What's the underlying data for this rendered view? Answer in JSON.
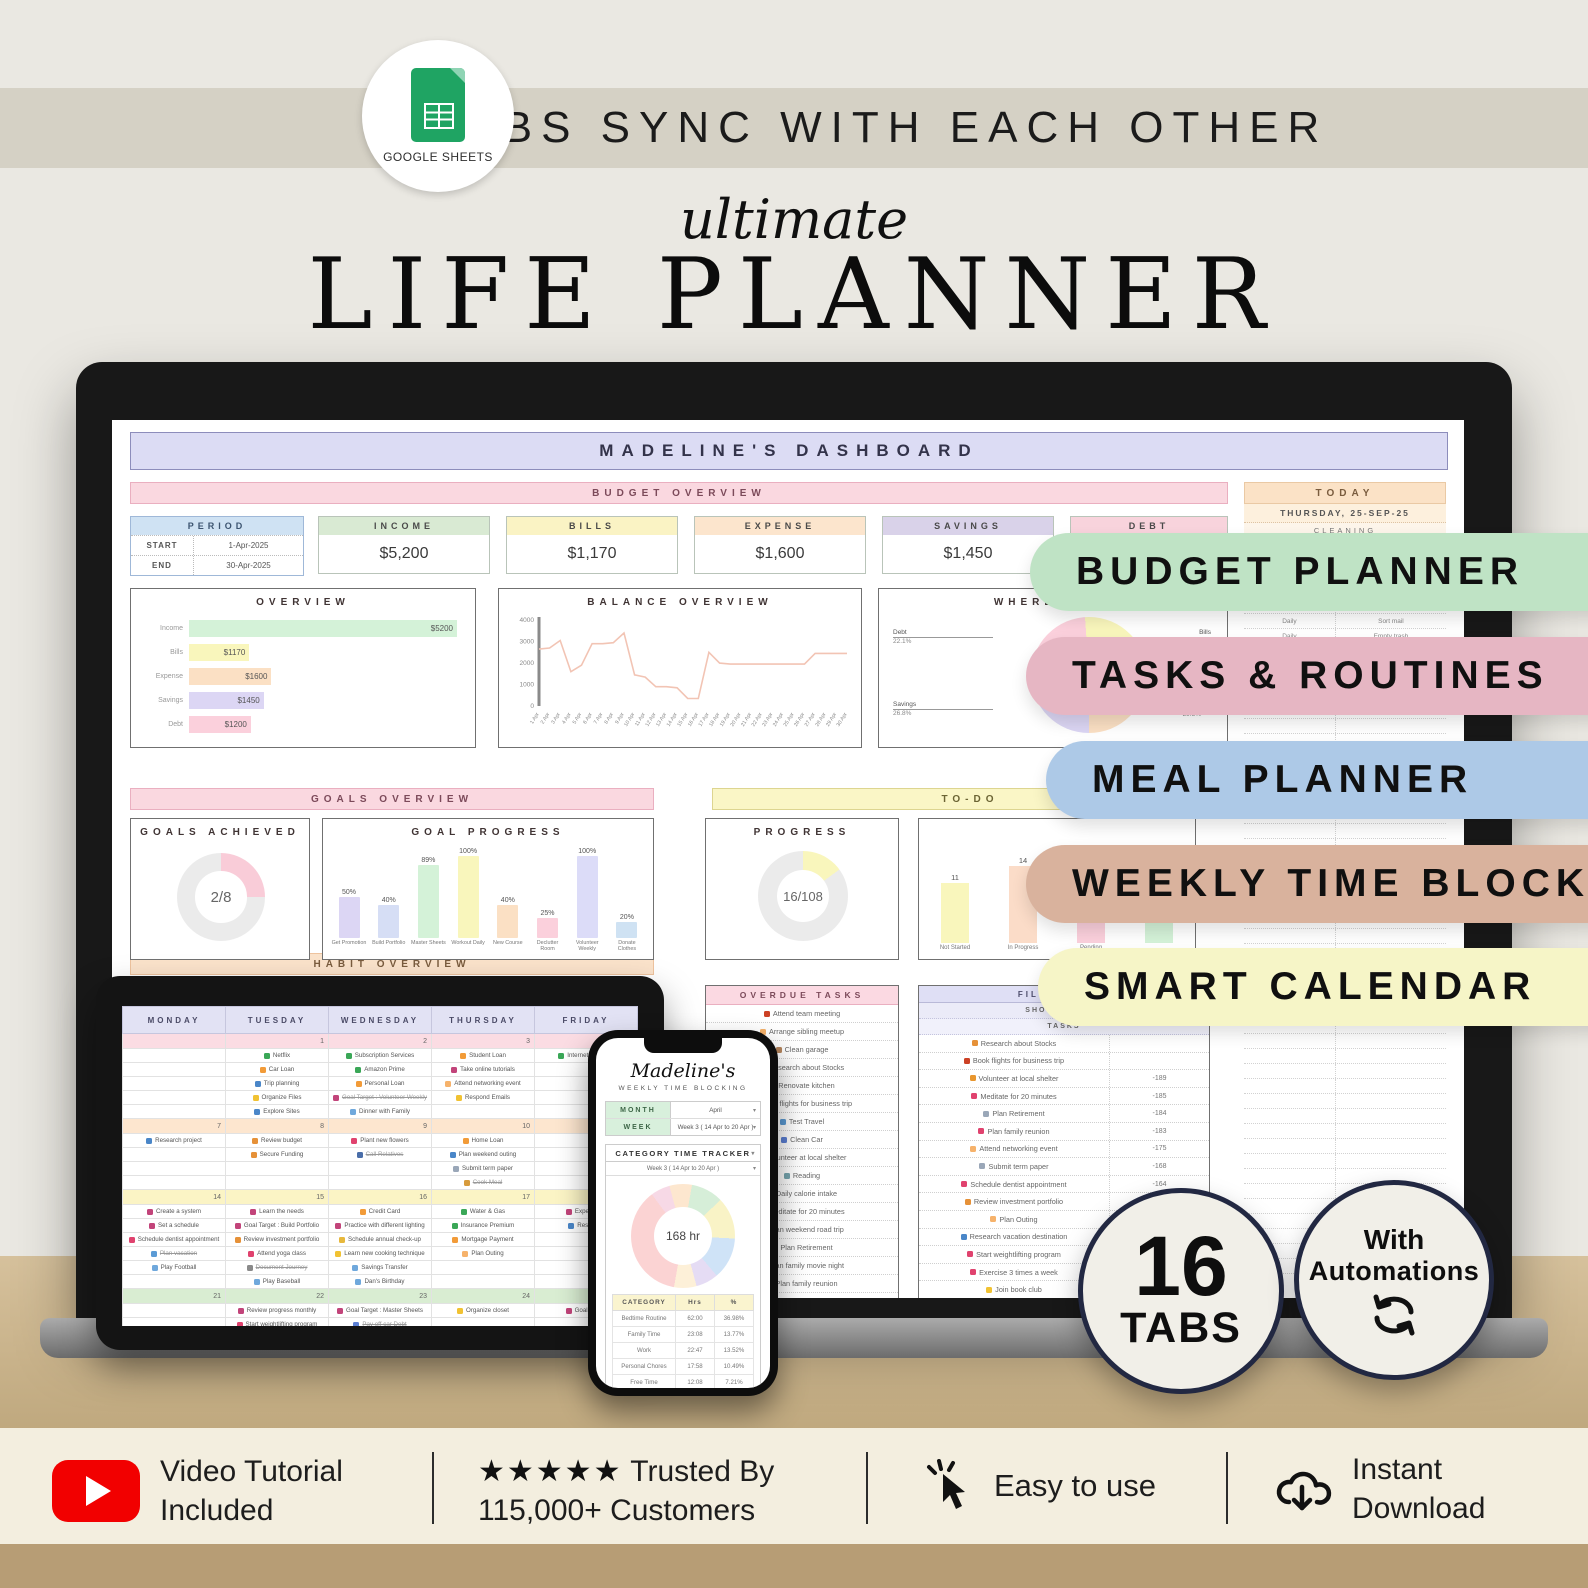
{
  "banner": {
    "logo_label": "GOOGLE SHEETS",
    "text": "TABS SYNC WITH EACH OTHER"
  },
  "title": {
    "script": "ultimate",
    "main": "LIFE PLANNER"
  },
  "dashboard": {
    "header": "MADELINE'S DASHBOARD",
    "sections": {
      "budget": "BUDGET OVERVIEW",
      "goals": "GOALS OVERVIEW",
      "todo": "TO-DO",
      "habit": "HABIT OVERVIEW"
    },
    "period": {
      "title": "PERIOD",
      "start_label": "START",
      "start": "1-Apr-2025",
      "end_label": "END",
      "end": "30-Apr-2025"
    },
    "kpis": [
      {
        "label": "INCOME",
        "value": "$5,200",
        "color": "#d9ead3"
      },
      {
        "label": "BILLS",
        "value": "$1,170",
        "color": "#faf3c4"
      },
      {
        "label": "EXPENSE",
        "value": "$1,600",
        "color": "#fce5cd"
      },
      {
        "label": "SAVINGS",
        "value": "$1,450",
        "color": "#d9d2e9"
      },
      {
        "label": "DEBT",
        "value": "",
        "color": "#f8d3dc"
      }
    ],
    "overview": {
      "title": "OVERVIEW",
      "max": 5200,
      "bars": [
        {
          "label": "Income",
          "value": "$5200",
          "num": 5200,
          "color": "#d4f2d8"
        },
        {
          "label": "Bills",
          "value": "$1170",
          "num": 1170,
          "color": "#f9f6bc"
        },
        {
          "label": "Expense",
          "value": "$1600",
          "num": 1600,
          "color": "#fbe0c4"
        },
        {
          "label": "Savings",
          "value": "$1450",
          "num": 1450,
          "color": "#dcd6f4"
        },
        {
          "label": "Debt",
          "value": "$1200",
          "num": 1200,
          "color": "#fbd0dc"
        }
      ]
    },
    "balance": {
      "title": "BALANCE OVERVIEW",
      "ymax": 4000,
      "yticks": [
        "4000",
        "3000",
        "2000",
        "1000",
        "0"
      ],
      "values": [
        2600,
        2650,
        3000,
        1550,
        1850,
        2850,
        2850,
        2900,
        3350,
        1400,
        1300,
        850,
        850,
        800,
        300,
        300,
        2450,
        1950,
        1900,
        1900,
        1900,
        1900,
        1900,
        1900,
        1900,
        1900,
        2400,
        2400,
        2400,
        2400
      ],
      "xlabels": [
        "1 Apr",
        "2 Apr",
        "3 Apr",
        "4 Apr",
        "5 Apr",
        "6 Apr",
        "7 Apr",
        "8 Apr",
        "9 Apr",
        "10 Apr",
        "11 Apr",
        "12 Apr",
        "13 Apr",
        "14 Apr",
        "15 Apr",
        "16 Apr",
        "17 Apr",
        "18 Apr",
        "19 Apr",
        "20 Apr",
        "21 Apr",
        "22 Apr",
        "23 Apr",
        "24 Apr",
        "25 Apr",
        "26 Apr",
        "27 Apr",
        "28 Apr",
        "29 Apr",
        "30 Apr"
      ]
    },
    "where": {
      "title": "WHERE DOES",
      "callouts": [
        {
          "label": "Debt",
          "pct": "22.1%"
        },
        {
          "label": "Savings",
          "pct": "26.8%"
        },
        {
          "label": "Bills",
          "pct": ""
        },
        {
          "label": "",
          "pct": "29.5%"
        }
      ],
      "segments": [
        {
          "color": "#dcd6f4",
          "pct": 26.8
        },
        {
          "color": "#fbd0dc",
          "pct": 22.1
        },
        {
          "color": "#f9f6bc",
          "pct": 21.6
        },
        {
          "color": "#fbe0c4",
          "pct": 29.5
        }
      ]
    },
    "today": {
      "title": "TODAY",
      "date": "THURSDAY, 25-SEP-25",
      "sub": "CLEANING",
      "rows": [
        [
          "Daily",
          "Sort mail"
        ],
        [
          "Daily",
          "Empty trash"
        ]
      ]
    },
    "goals_achieved": {
      "title": "GOALS ACHIEVED",
      "value": "2/8",
      "pct": 25,
      "color": "#f9ccd8"
    },
    "goal_progress": {
      "title": "GOAL PROGRESS",
      "bars": [
        {
          "label": "Get Promotion",
          "pct": 50,
          "color": "#dcd6f4"
        },
        {
          "label": "Build Portfolio",
          "pct": 40,
          "color": "#d6def5"
        },
        {
          "label": "Master Sheets",
          "pct": 89,
          "color": "#d4f2d8"
        },
        {
          "label": "Workout Daily",
          "pct": 100,
          "color": "#f9f6bc"
        },
        {
          "label": "New Course",
          "pct": 40,
          "color": "#fbe0c4"
        },
        {
          "label": "Declutter Room",
          "pct": 25,
          "color": "#fbd0dc"
        },
        {
          "label": "Volunteer Weekly",
          "pct": 100,
          "color": "#dcdcf8"
        },
        {
          "label": "Donate Clothes",
          "pct": 20,
          "color": "#cfe2f3"
        }
      ]
    },
    "progress": {
      "title": "PROGRESS",
      "value": "16/108",
      "pct": 15,
      "color": "#f9f6bc"
    },
    "status": {
      "bars": [
        {
          "label": "Not Started",
          "value": 11,
          "color": "#f9f6bc"
        },
        {
          "label": "In Progress",
          "value": 14,
          "color": "#fbdcc8"
        },
        {
          "label": "Pending",
          "value": 14,
          "color": "#fbd0dc"
        },
        {
          "label": "Completed",
          "value": 16,
          "color": "#d4f2d8"
        }
      ]
    },
    "overdue": {
      "title": "OVERDUE TASKS",
      "items": [
        {
          "icon": "book-red",
          "text": "Attend team meeting"
        },
        {
          "icon": "people",
          "text": "Arrange sibling meetup"
        },
        {
          "icon": "broom",
          "text": "Clean garage"
        },
        {
          "icon": "book-orange",
          "text": "Research about Stocks"
        },
        {
          "icon": "home",
          "text": "Renovate kitchen"
        },
        {
          "icon": "book-red",
          "text": "Book flights for business trip"
        },
        {
          "icon": "plane",
          "text": "Test Travel"
        },
        {
          "icon": "car",
          "text": "Clean Car"
        },
        {
          "icon": "shield",
          "text": "Volunteer at local shelter"
        },
        {
          "icon": "reading",
          "text": "Reading"
        },
        {
          "icon": "apple",
          "text": "Daily calorie intake"
        },
        {
          "icon": "heart",
          "text": "Meditate for 20 minutes"
        },
        {
          "icon": "car",
          "text": "Plan weekend road trip"
        },
        {
          "icon": "doc",
          "text": "Plan Retirement"
        },
        {
          "icon": "movie",
          "text": "Plan family movie night"
        },
        {
          "icon": "heart",
          "text": "Plan family reunion"
        },
        {
          "icon": "chart",
          "text": "Prepare quarterly report"
        }
      ]
    },
    "filter": {
      "title": "FILTER TASKS",
      "subtitle": "SHOW WITH AC",
      "col": "TASKS",
      "rows": [
        {
          "icon": "book-orange",
          "text": "Research about Stocks",
          "days": ""
        },
        {
          "icon": "book-red",
          "text": "Book flights for business trip",
          "days": ""
        },
        {
          "icon": "shield",
          "text": "Volunteer at local shelter",
          "days": "-189"
        },
        {
          "icon": "heart",
          "text": "Meditate for 20 minutes",
          "days": "-185"
        },
        {
          "icon": "doc",
          "text": "Plan Retirement",
          "days": "-184"
        },
        {
          "icon": "heart",
          "text": "Plan family reunion",
          "days": "-183"
        },
        {
          "icon": "people",
          "text": "Attend networking event",
          "days": "-175"
        },
        {
          "icon": "doc",
          "text": "Submit term paper",
          "days": "-168"
        },
        {
          "icon": "heart",
          "text": "Schedule dentist appointment",
          "days": "-164"
        },
        {
          "icon": "book-orange",
          "text": "Review investment portfolio",
          "days": "-163"
        },
        {
          "icon": "people",
          "text": "Plan Outing",
          "days": "-161"
        },
        {
          "icon": "book-blue",
          "text": "Research vacation destination",
          "days": ""
        },
        {
          "icon": "heart",
          "text": "Start weightlifting program",
          "days": ""
        },
        {
          "icon": "heart",
          "text": "Exercise 3 times a week",
          "days": ""
        },
        {
          "icon": "note-yellow",
          "text": "Join book club",
          "days": ""
        },
        {
          "icon": "chart",
          "text": "Review sales data",
          "days": ""
        }
      ]
    }
  },
  "tablet": {
    "days": [
      "MONDAY",
      "TUESDAY",
      "WEDNESDAY",
      "THURSDAY",
      "FRIDAY"
    ],
    "weeks": [
      {
        "color": "#fbdce3",
        "dates": [
          "",
          "1",
          "2",
          "3",
          "4"
        ],
        "cells": [
          [],
          [
            {
              "i": "sheet-green",
              "t": "Netflix"
            },
            {
              "i": "loan-orange",
              "t": "Car Loan"
            },
            {
              "i": "book-blue",
              "t": "Trip planning"
            },
            {
              "i": "note-yellow",
              "t": "Organize Files"
            },
            {
              "i": "book-blue",
              "t": "Explore Sites"
            }
          ],
          [
            {
              "i": "sheet-green",
              "t": "Subscription Services"
            },
            {
              "i": "sheet-green",
              "t": "Amazon Prime"
            },
            {
              "i": "loan-orange",
              "t": "Personal Loan"
            },
            {
              "i": "target-pink",
              "t": "Goal Target : Volunteer Weekly",
              "s": true
            },
            {
              "i": "calendar",
              "t": "Dinner with Family"
            }
          ],
          [
            {
              "i": "loan-orange",
              "t": "Student Loan"
            },
            {
              "i": "target-pink",
              "t": "Take online tutorials"
            },
            {
              "i": "people",
              "t": "Attend networking event"
            },
            {
              "i": "note-yellow",
              "t": "Respond Emails"
            }
          ],
          [
            {
              "i": "sheet-green",
              "t": "Internet & Phone"
            }
          ]
        ]
      },
      {
        "color": "#fde6cf",
        "dates": [
          "7",
          "8",
          "9",
          "10",
          "11"
        ],
        "cells": [
          [
            {
              "i": "book-blue",
              "t": "Research project"
            }
          ],
          [
            {
              "i": "book-orange",
              "t": "Review budget"
            },
            {
              "i": "book-orange",
              "t": "Secure Funding"
            }
          ],
          [
            {
              "i": "heart",
              "t": "Plant new flowers"
            },
            {
              "i": "phone",
              "t": "Call Relatives",
              "s": true
            }
          ],
          [
            {
              "i": "loan-orange",
              "t": "Home Loan"
            },
            {
              "i": "book-blue",
              "t": "Plan weekend outing"
            },
            {
              "i": "doc",
              "t": "Submit term paper"
            },
            {
              "i": "pan",
              "t": "Cook Meal",
              "s": true
            }
          ],
          []
        ]
      },
      {
        "color": "#fbf4c5",
        "dates": [
          "14",
          "15",
          "16",
          "17",
          "18"
        ],
        "cells": [
          [
            {
              "i": "target-pink",
              "t": "Create a system"
            },
            {
              "i": "target-pink",
              "t": "Set a schedule"
            },
            {
              "i": "heart",
              "t": "Schedule dentist appointment"
            },
            {
              "i": "plane",
              "t": "Plan vacation",
              "s": true
            },
            {
              "i": "calendar",
              "t": "Play Football"
            }
          ],
          [
            {
              "i": "target-pink",
              "t": "Learn the needs"
            },
            {
              "i": "target-pink",
              "t": "Goal Target : Build Portfolio"
            },
            {
              "i": "book-orange",
              "t": "Review investment portfolio"
            },
            {
              "i": "heart",
              "t": "Attend yoga class"
            },
            {
              "i": "camera",
              "t": "Document Journey",
              "s": true
            },
            {
              "i": "calendar",
              "t": "Play Baseball"
            }
          ],
          [
            {
              "i": "loan-orange",
              "t": "Credit Card"
            },
            {
              "i": "target-pink",
              "t": "Practice with different lighting"
            },
            {
              "i": "heart-yellow",
              "t": "Schedule annual check-up"
            },
            {
              "i": "note-yellow",
              "t": "Learn new cooking technique"
            },
            {
              "i": "calendar",
              "t": "Savings Transfer"
            },
            {
              "i": "calendar",
              "t": "Dan's Birthday"
            }
          ],
          [
            {
              "i": "sheet-green",
              "t": "Water & Gas"
            },
            {
              "i": "sheet-green",
              "t": "Insurance Premium"
            },
            {
              "i": "loan-orange",
              "t": "Mortgage Payment"
            },
            {
              "i": "people",
              "t": "Plan Outing"
            }
          ],
          [
            {
              "i": "target-pink",
              "t": "Experiment"
            },
            {
              "i": "book-blue",
              "t": "Research"
            }
          ]
        ]
      },
      {
        "color": "#d9edd2",
        "dates": [
          "21",
          "22",
          "23",
          "24",
          "25"
        ],
        "cells": [
          [],
          [
            {
              "i": "target-pink",
              "t": "Review progress monthly"
            },
            {
              "i": "heart",
              "t": "Start weightlifting program"
            },
            {
              "i": "heart",
              "t": "Sleep Well"
            }
          ],
          [
            {
              "i": "target-pink",
              "t": "Goal Target : Master Sheets"
            },
            {
              "i": "car",
              "t": "Pay off car Debt",
              "s": true
            }
          ],
          [
            {
              "i": "note-yellow",
              "t": "Organize closet"
            }
          ],
          [
            {
              "i": "target-pink",
              "t": "Goal Target"
            }
          ]
        ]
      },
      {
        "color": "#d2e2f4",
        "dates": [
          "28",
          "29",
          "30",
          "",
          ""
        ],
        "cells": [
          [],
          [],
          [],
          [],
          []
        ]
      }
    ]
  },
  "phone": {
    "name": "Madeline's",
    "subtitle": "WEEKLY TIME BLOCKING",
    "month_label": "MONTH",
    "month": "April",
    "week_label": "WEEK",
    "week": "Week 3 ( 14 Apr to 20 Apr )",
    "tracker_title": "CATEGORY TIME TRACKER",
    "tracker_week": "Week 3 ( 14 Apr to 20 Apr )",
    "donut_center": "168 hr",
    "donut_segments": [
      {
        "color": "#fbd3d3",
        "pct": 37
      },
      {
        "color": "#f7d9e6",
        "pct": 6
      },
      {
        "color": "#fde7cf",
        "pct": 7
      },
      {
        "color": "#d6eed8",
        "pct": 10
      },
      {
        "color": "#f9f3c6",
        "pct": 13
      },
      {
        "color": "#cfe3f7",
        "pct": 13
      },
      {
        "color": "#e5dcf4",
        "pct": 7
      },
      {
        "color": "#fdf0d8",
        "pct": 7
      }
    ],
    "table": {
      "headers": [
        "CATEGORY",
        "Hrs",
        "%"
      ],
      "rows": [
        [
          "Bedtime Routine",
          "62:00",
          "36.98%"
        ],
        [
          "Family Time",
          "23:08",
          "13.77%"
        ],
        [
          "Work",
          "22:47",
          "13.52%"
        ],
        [
          "Personal Chores",
          "17:58",
          "10.49%"
        ],
        [
          "Free Time",
          "12:08",
          "7.21%"
        ],
        [
          "Errands",
          "11:08",
          "6.63%"
        ],
        [
          "Morning Routine",
          "10:58",
          "6.31%"
        ],
        [
          "Commute",
          "8:58",
          "5.12%"
        ]
      ]
    }
  },
  "pills": [
    {
      "label": "BUDGET PLANNER",
      "color": "#bfe3c5"
    },
    {
      "label": "TASKS & ROUTINES",
      "color": "#e6b6c3"
    },
    {
      "label": "MEAL PLANNER",
      "color": "#adc9e7"
    },
    {
      "label": "WEEKLY TIME BLOCK",
      "color": "#d9b29d"
    },
    {
      "label": "SMART CALENDAR",
      "color": "#f6f5c7"
    }
  ],
  "badges": {
    "tabs": {
      "number": "16",
      "label": "TABS"
    },
    "automations": {
      "line1": "With",
      "line2": "Automations"
    }
  },
  "features": {
    "video": {
      "line1": "Video Tutorial",
      "line2": "Included"
    },
    "trusted": {
      "stars": "★★★★★",
      "line1": "Trusted By",
      "line2": "115,000+ Customers"
    },
    "easy": {
      "label": "Easy to use"
    },
    "download": {
      "line1": "Instant",
      "line2": "Download"
    }
  }
}
